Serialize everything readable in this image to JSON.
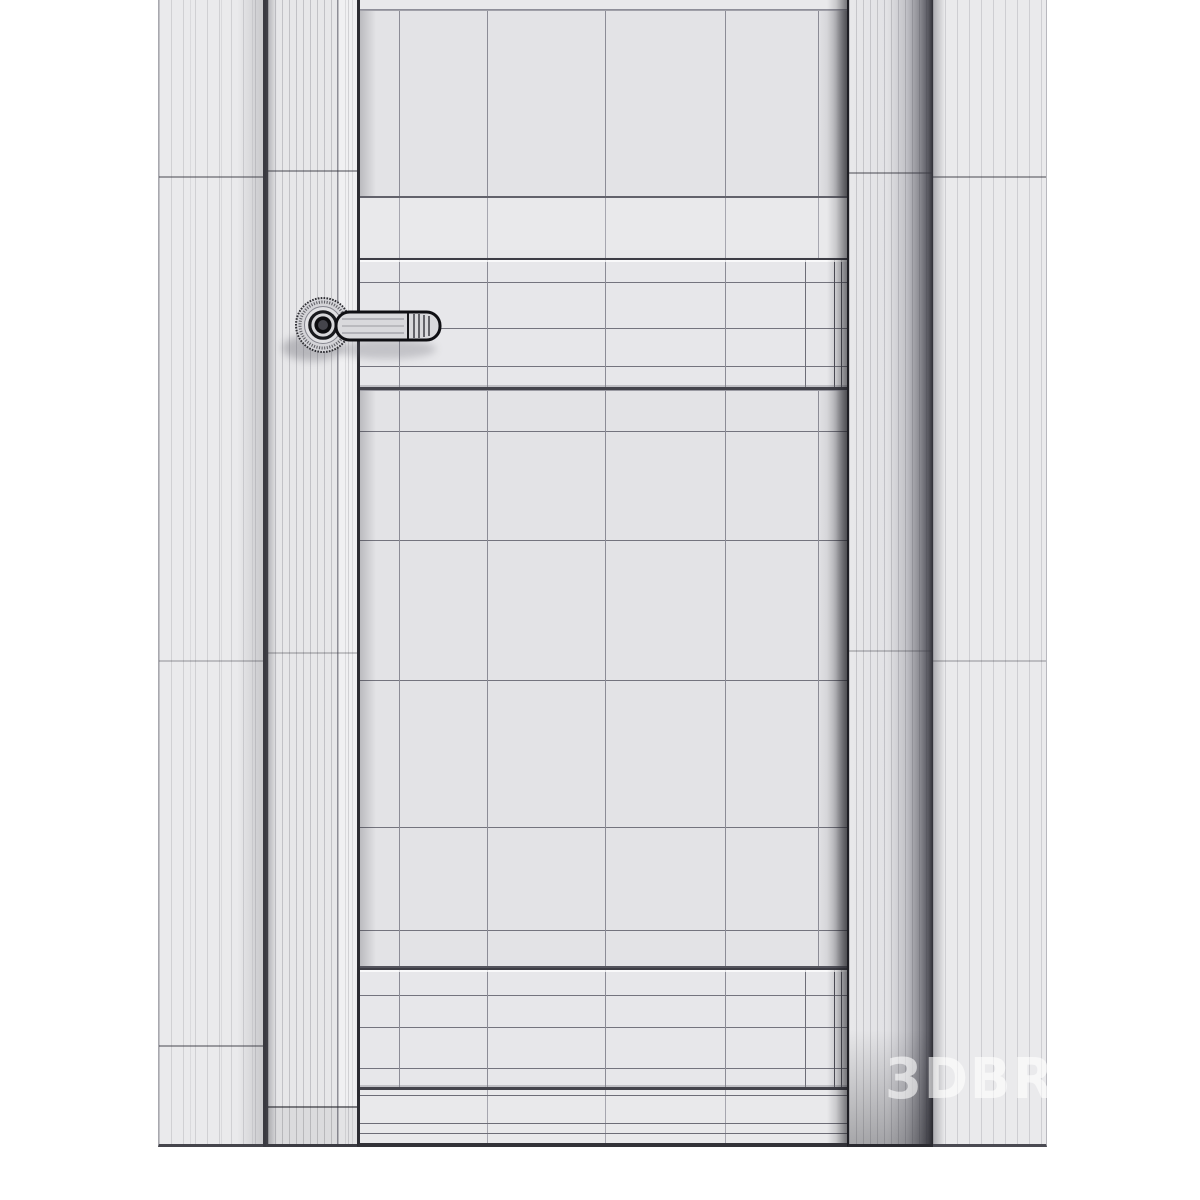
{
  "watermark": {
    "text": "3DBRU"
  },
  "scene": {
    "type": "3d-wireframe-render",
    "subject": "interior door with fluted casing, fluted wall panels and lever handle",
    "parts": [
      "left-wall-panel-fluted",
      "left-door-casing-fluted",
      "door-leaf",
      "door-top-recessed-panel",
      "door-lock-rail-band",
      "door-middle-recessed-panel",
      "door-bottom-rail-band",
      "door-lever-handle",
      "handle-rosette",
      "right-door-casing-fluted",
      "right-wall-panel-fluted"
    ]
  },
  "colors": {
    "background": "#ffffff",
    "panel_light": "#eaeaec",
    "door_face": "#e9e9eb",
    "panel_recessed": "#e3e3e6",
    "stripe_line": "#b4b4ba",
    "wire_line": "#8c8c96",
    "wire_strong": "#74747e",
    "edge_dark": "#35353b",
    "recess_dark": "#2b2b31",
    "handle_metal": "#d9d9dc",
    "handle_outline": "#0f0f13",
    "watermark_color": "rgba(255,255,255,0.60)"
  }
}
